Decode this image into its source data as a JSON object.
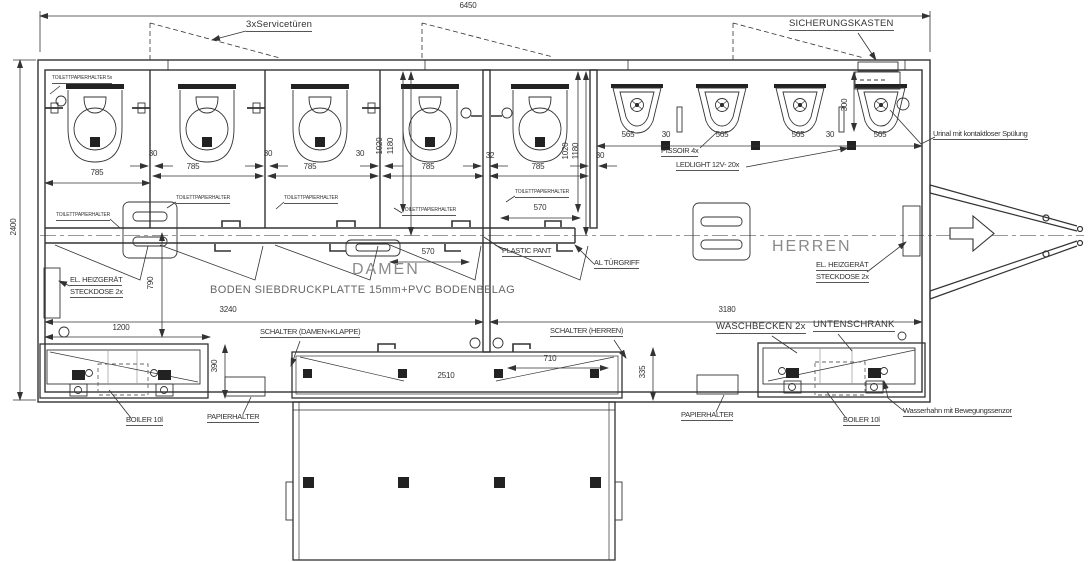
{
  "drawing": {
    "labels": {
      "service_doors": "3xServicetüren",
      "fuse_box": "SICHERUNGSKASTEN",
      "tp_main": "TOILETTPAPIERHALTER 5x",
      "tp": "TOILETTPAPIERHALTER",
      "pissoir": "PISSOIR 4x",
      "ledlight": "LEDLIGHT 12V- 20x",
      "urinal_flush": "Urinal mit kontaktloser Spülung",
      "damen": "DAMEN",
      "herren": "HERREN",
      "floor": "BODEN SIEBDRUCKPLATTE 15mm+PVC BODENBELAG",
      "heater1": "EL. HEIZGERÄT",
      "heater2": "STECKDOSE 2x",
      "plastic_pant": "PLASTIC PANT",
      "tuergriff": "AL TÜRGRIFF",
      "schalter_damen": "SCHALTER (DAMEN+KLAPPE)",
      "schalter_herren": "SCHALTER (HERREN)",
      "waschbecken": "WASCHBECKEN 2x",
      "untenschrank": "UNTENSCHRANK",
      "papierhalter": "PAPIERHALTER",
      "boiler": "BOILER 10l",
      "wasserhahn": "Wasserhahn mit Bewegungssenzor"
    },
    "dims": {
      "length": "6450",
      "width": "2400",
      "stall": "785",
      "gap30": "30",
      "gap32": "32",
      "urinal": "565",
      "d1020": "1020",
      "d1180": "1180",
      "d300": "300",
      "door": "570",
      "corridor": "790",
      "damen_len": "3240",
      "herren_len": "3180",
      "basin": "1200",
      "basin_depth": "390",
      "flap": "2510",
      "herren_counter": "710",
      "counter_depth": "335"
    },
    "colors": {
      "line": "#333",
      "room_text": "#8a8a8a"
    }
  }
}
